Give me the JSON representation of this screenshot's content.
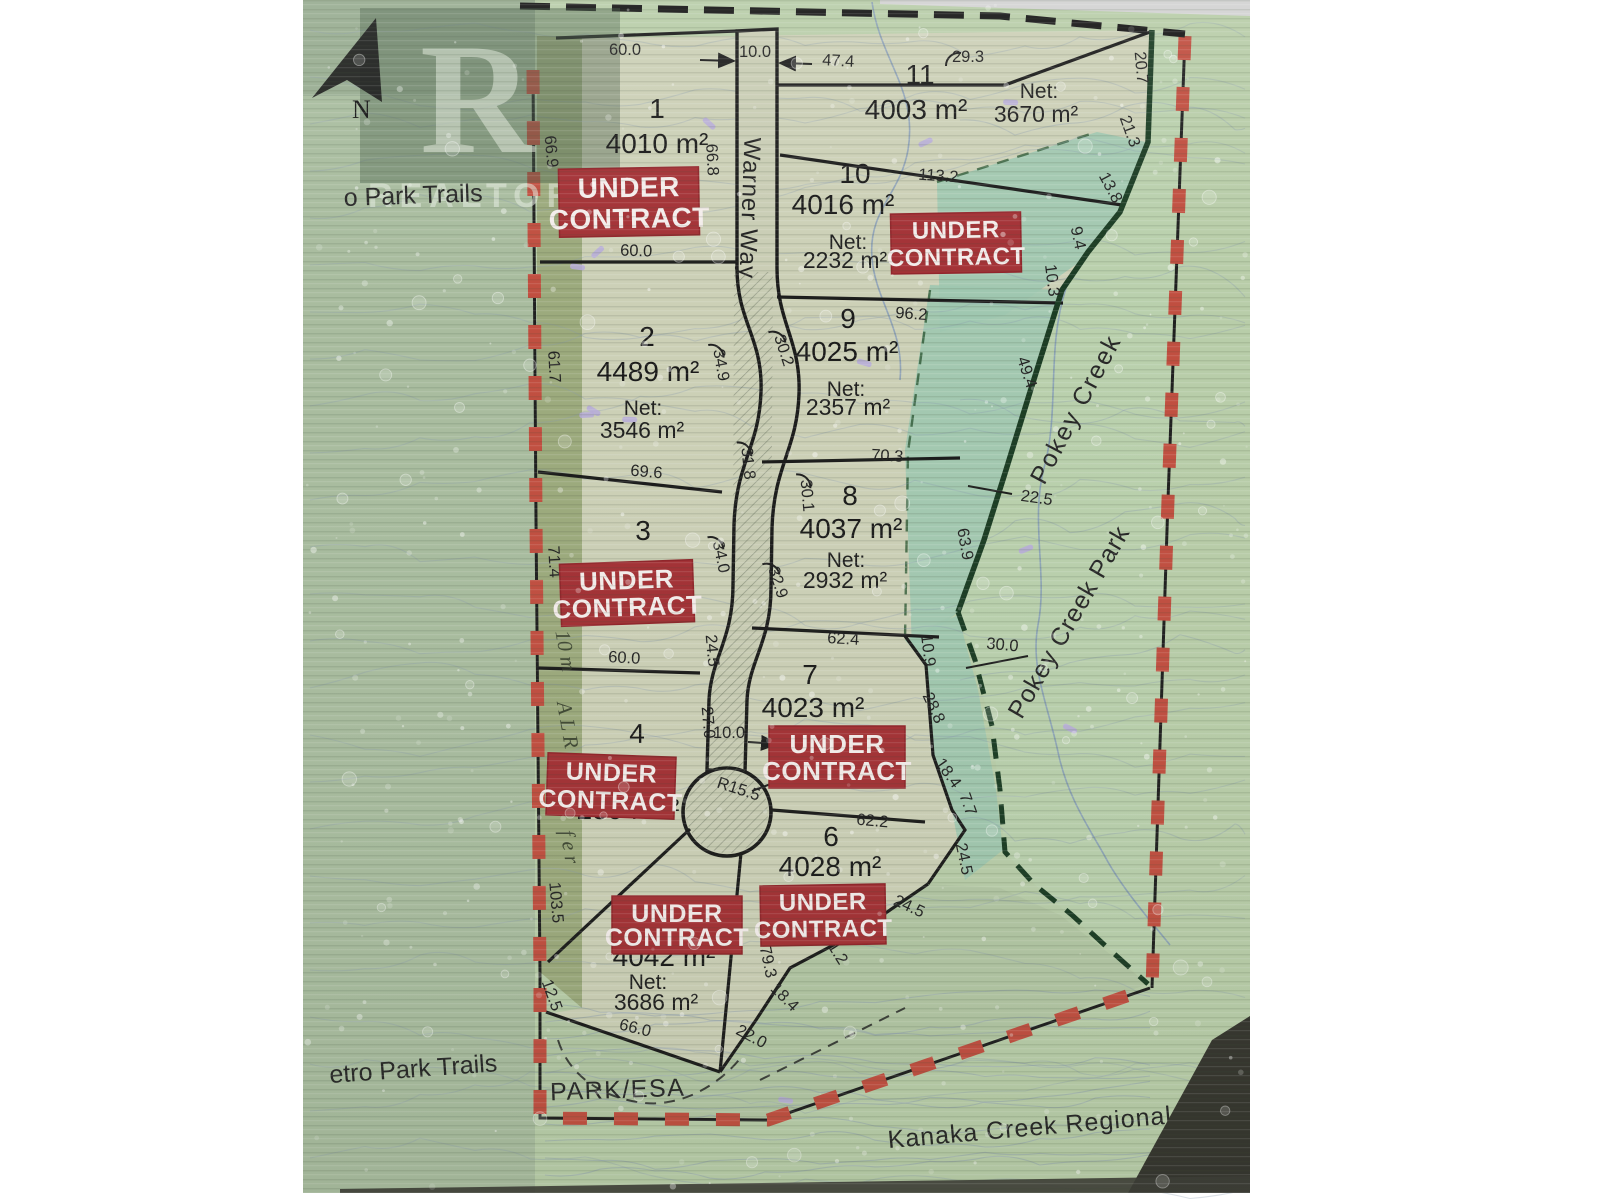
{
  "sign": {
    "colors": {
      "sticker_red": "#a12d31",
      "boundary_red": "#bf4b3c",
      "park_boundary_green": "#16381f",
      "map_base": "#b7cca7",
      "lot_fill": "#cbcfb5",
      "teal_esa": "#9cc5ae",
      "olive_band": "#9aa87a",
      "left_sage": "#a7bb9d"
    },
    "watermark": {
      "logo_letter": "R",
      "brand": "REALTOR®"
    },
    "north_label": "N",
    "road_name": "Warner Way",
    "net_label_text": "Net:",
    "sticker_lines": [
      "UNDER",
      "CONTRACT"
    ],
    "stickers": [
      {
        "lot": "1",
        "cx": 629,
        "cy": 202,
        "w": 140,
        "h": 68,
        "rot": -1,
        "fs": 28
      },
      {
        "lot": "3",
        "cx": 627,
        "cy": 593,
        "w": 133,
        "h": 62,
        "rot": -2,
        "fs": 26
      },
      {
        "lot": "4",
        "cx": 611,
        "cy": 786,
        "w": 128,
        "h": 62,
        "rot": 2,
        "fs": 25
      },
      {
        "lot": "5",
        "cx": 677,
        "cy": 925,
        "w": 130,
        "h": 58,
        "rot": 0,
        "fs": 25
      },
      {
        "lot": "6",
        "cx": 823,
        "cy": 915,
        "w": 125,
        "h": 60,
        "rot": -1,
        "fs": 24
      },
      {
        "lot": "7",
        "cx": 837,
        "cy": 757,
        "w": 136,
        "h": 62,
        "rot": 0,
        "fs": 26
      },
      {
        "lot": "10",
        "cx": 956,
        "cy": 243,
        "w": 130,
        "h": 60,
        "rot": -1,
        "fs": 24
      }
    ],
    "lots": [
      {
        "number": "1",
        "area": "4010 m²",
        "net": null,
        "pos": {
          "num": [
            657,
            118
          ],
          "area": [
            657,
            153
          ]
        }
      },
      {
        "number": "2",
        "area": "4489 m²",
        "net": "3546 m²",
        "pos": {
          "num": [
            647,
            346
          ],
          "area": [
            648,
            381
          ],
          "net_label": [
            643,
            415
          ],
          "net": [
            642,
            438
          ]
        }
      },
      {
        "number": "3",
        "area": null,
        "net": null,
        "pos": {
          "num": [
            643,
            540
          ]
        }
      },
      {
        "number": "4",
        "area": "2594 m²",
        "net": null,
        "pos": {
          "num": [
            637,
            743
          ],
          "area": [
            628,
            819
          ]
        }
      },
      {
        "number": "5",
        "area": "4042 m²",
        "net": "3686 m²",
        "pos": {
          "area": [
            664,
            966
          ],
          "net_label": [
            648,
            989
          ],
          "net": [
            656,
            1010
          ]
        }
      },
      {
        "number": "6",
        "area": "4028 m²",
        "net": null,
        "pos": {
          "num": [
            831,
            846
          ],
          "area": [
            830,
            876
          ]
        }
      },
      {
        "number": "7",
        "area": "4023 m²",
        "net": null,
        "pos": {
          "num": [
            810,
            684
          ],
          "area": [
            813,
            717
          ]
        }
      },
      {
        "number": "8",
        "area": "4037 m²",
        "net": "2932 m²",
        "pos": {
          "num": [
            850,
            505
          ],
          "area": [
            851,
            538
          ],
          "net_label": [
            846,
            567
          ],
          "net": [
            845,
            588
          ]
        }
      },
      {
        "number": "9",
        "area": "4025 m²",
        "net": "2357 m²",
        "pos": {
          "num": [
            848,
            328
          ],
          "area": [
            847,
            361
          ],
          "net_label": [
            846,
            396
          ],
          "net": [
            848,
            415
          ]
        }
      },
      {
        "number": "10",
        "area": "4016 m²",
        "net": "2232 m²",
        "pos": {
          "num": [
            855,
            183
          ],
          "area": [
            843,
            214
          ],
          "net_label": [
            848,
            249
          ],
          "net": [
            845,
            268
          ]
        }
      },
      {
        "number": "11",
        "area": "4003 m²",
        "net": "3670 m²",
        "pos": {
          "num": [
            920,
            84
          ],
          "area": [
            916,
            119
          ],
          "net_label": [
            1039,
            98
          ],
          "net": [
            1036,
            122
          ]
        }
      }
    ],
    "place_labels": [
      {
        "name": "trails-top",
        "text": "o Park Trails",
        "x": 344,
        "y": 206,
        "r": -2,
        "fs": 26,
        "anchor": "start",
        "cls": "place"
      },
      {
        "name": "trails-bottom",
        "text": "etro Park Trails",
        "x": 330,
        "y": 1083,
        "r": -4,
        "fs": 27,
        "anchor": "start",
        "cls": "place"
      },
      {
        "name": "park-esa",
        "text": "PARK/ESA",
        "x": 618,
        "y": 1098,
        "r": -2,
        "fs": 23,
        "anchor": "middle",
        "cls": "place",
        "ls": 1.5
      },
      {
        "name": "kanaka-creek-regional-park",
        "text": "Kanaka Creek Regional Park",
        "x": 1062,
        "y": 1133,
        "r": -5,
        "fs": 25,
        "anchor": "middle",
        "cls": "place",
        "ls": 1
      },
      {
        "name": "pokey-creek",
        "text": "Pokey Creek",
        "x": 1083,
        "y": 413,
        "r": -62,
        "fs": 27,
        "anchor": "middle",
        "cls": "place",
        "ls": 2
      },
      {
        "name": "pokey-creek-park",
        "text": "Pokey Creek Park",
        "x": 1076,
        "y": 626,
        "r": -60,
        "fs": 25,
        "anchor": "middle",
        "cls": "place",
        "ls": 1
      },
      {
        "name": "warner-way",
        "text": "Warner Way",
        "x": 742,
        "y": 208,
        "r": 92,
        "fs": 24,
        "anchor": "middle",
        "cls": "road-name",
        "ls": 1
      },
      {
        "name": "alr-10m",
        "text": "10 m",
        "x": 559,
        "y": 652,
        "r": 80,
        "fs": 21,
        "anchor": "middle",
        "cls": "band"
      },
      {
        "name": "alr",
        "text": "A L R",
        "x": 561,
        "y": 726,
        "r": 80,
        "fs": 21,
        "anchor": "middle",
        "cls": "band"
      },
      {
        "name": "alr-buffer",
        "text": "f e r",
        "x": 563,
        "y": 848,
        "r": 80,
        "fs": 21,
        "anchor": "middle",
        "cls": "band"
      }
    ],
    "measurements": [
      {
        "t": "60.0",
        "x": 625,
        "y": 55,
        "r": 0
      },
      {
        "t": "10.0",
        "x": 755,
        "y": 57,
        "r": 0
      },
      {
        "t": "47.4",
        "x": 838,
        "y": 66,
        "r": 3
      },
      {
        "t": "29.3",
        "x": 968,
        "y": 62,
        "r": 0,
        "arc": true
      },
      {
        "t": "20.7",
        "x": 1136,
        "y": 68,
        "r": 85
      },
      {
        "t": "66.9",
        "x": 546,
        "y": 152,
        "r": 85
      },
      {
        "t": "66.8",
        "x": 707,
        "y": 160,
        "r": 87
      },
      {
        "t": "21.3",
        "x": 1125,
        "y": 133,
        "r": 70
      },
      {
        "t": "13.8",
        "x": 1106,
        "y": 190,
        "r": 62
      },
      {
        "t": "9.4",
        "x": 1073,
        "y": 239,
        "r": 78
      },
      {
        "t": "10.3",
        "x": 1047,
        "y": 281,
        "r": 83
      },
      {
        "t": "113.2",
        "x": 938,
        "y": 181,
        "r": 4
      },
      {
        "t": "60.0",
        "x": 636,
        "y": 256,
        "r": 2
      },
      {
        "t": "61.7",
        "x": 549,
        "y": 367,
        "r": 87
      },
      {
        "t": "34.9",
        "x": 716,
        "y": 366,
        "r": 80,
        "arc": true
      },
      {
        "t": "30.2",
        "x": 779,
        "y": 352,
        "r": 72,
        "arc": true
      },
      {
        "t": "96.2",
        "x": 911,
        "y": 319,
        "r": 4
      },
      {
        "t": "49.4",
        "x": 1022,
        "y": 374,
        "r": 72
      },
      {
        "t": "31.8",
        "x": 743,
        "y": 464,
        "r": 84,
        "arc": true
      },
      {
        "t": "69.6",
        "x": 646,
        "y": 477,
        "r": 5
      },
      {
        "t": "70.3",
        "x": 887,
        "y": 461,
        "r": 3
      },
      {
        "t": "22.5",
        "x": 1036,
        "y": 503,
        "r": 8
      },
      {
        "t": "63.9",
        "x": 960,
        "y": 545,
        "r": 80
      },
      {
        "t": "71.4",
        "x": 549,
        "y": 562,
        "r": 87
      },
      {
        "t": "34.0",
        "x": 716,
        "y": 558,
        "r": 78,
        "arc": true
      },
      {
        "t": "30.1",
        "x": 802,
        "y": 496,
        "r": 85,
        "arc": true
      },
      {
        "t": "32.9",
        "x": 773,
        "y": 584,
        "r": 72,
        "arc": true
      },
      {
        "t": "24.5",
        "x": 707,
        "y": 651,
        "r": 85
      },
      {
        "t": "60.0",
        "x": 624,
        "y": 663,
        "r": 3
      },
      {
        "t": "62.4",
        "x": 843,
        "y": 644,
        "r": 3
      },
      {
        "t": "10.9",
        "x": 923,
        "y": 651,
        "r": 83
      },
      {
        "t": "30.0",
        "x": 1002,
        "y": 650,
        "r": 5
      },
      {
        "t": "28.8",
        "x": 929,
        "y": 710,
        "r": 65
      },
      {
        "t": "27.0",
        "x": 703,
        "y": 723,
        "r": 85
      },
      {
        "t": "10.0",
        "x": 729,
        "y": 738,
        "r": 0
      },
      {
        "t": "18.4",
        "x": 944,
        "y": 776,
        "r": 55
      },
      {
        "t": "R15.5",
        "x": 737,
        "y": 794,
        "r": 18
      },
      {
        "t": "7.7",
        "x": 963,
        "y": 806,
        "r": 70
      },
      {
        "t": "62.2",
        "x": 872,
        "y": 826,
        "r": 5
      },
      {
        "t": "24.5",
        "x": 959,
        "y": 860,
        "r": 78
      },
      {
        "t": "103.5",
        "x": 551,
        "y": 903,
        "r": 85
      },
      {
        "t": "24.5",
        "x": 907,
        "y": 911,
        "r": 25
      },
      {
        "t": "31.2",
        "x": 831,
        "y": 952,
        "r": 58
      },
      {
        "t": "79.3",
        "x": 763,
        "y": 963,
        "r": 78
      },
      {
        "t": "12.5",
        "x": 547,
        "y": 997,
        "r": 70
      },
      {
        "t": "18.4",
        "x": 781,
        "y": 1001,
        "r": 45
      },
      {
        "t": "22.0",
        "x": 749,
        "y": 1041,
        "r": 28
      },
      {
        "t": "66.0",
        "x": 634,
        "y": 1033,
        "r": 14
      }
    ],
    "leaders": [
      {
        "x1": 968,
        "y1": 486,
        "x2": 1012,
        "y2": 494,
        "arrow": false
      },
      {
        "x1": 966,
        "y1": 668,
        "x2": 1028,
        "y2": 656,
        "arrow": false
      },
      {
        "x1": 748,
        "y1": 742,
        "x2": 777,
        "y2": 744,
        "arrow": true
      },
      {
        "x1": 700,
        "y1": 60,
        "x2": 734,
        "y2": 61,
        "arrow": true
      },
      {
        "x1": 812,
        "y1": 64,
        "x2": 780,
        "y2": 63,
        "arrow": true
      },
      {
        "x1": 752,
        "y1": 791,
        "x2": 792,
        "y2": 776,
        "arrow": false
      }
    ]
  }
}
